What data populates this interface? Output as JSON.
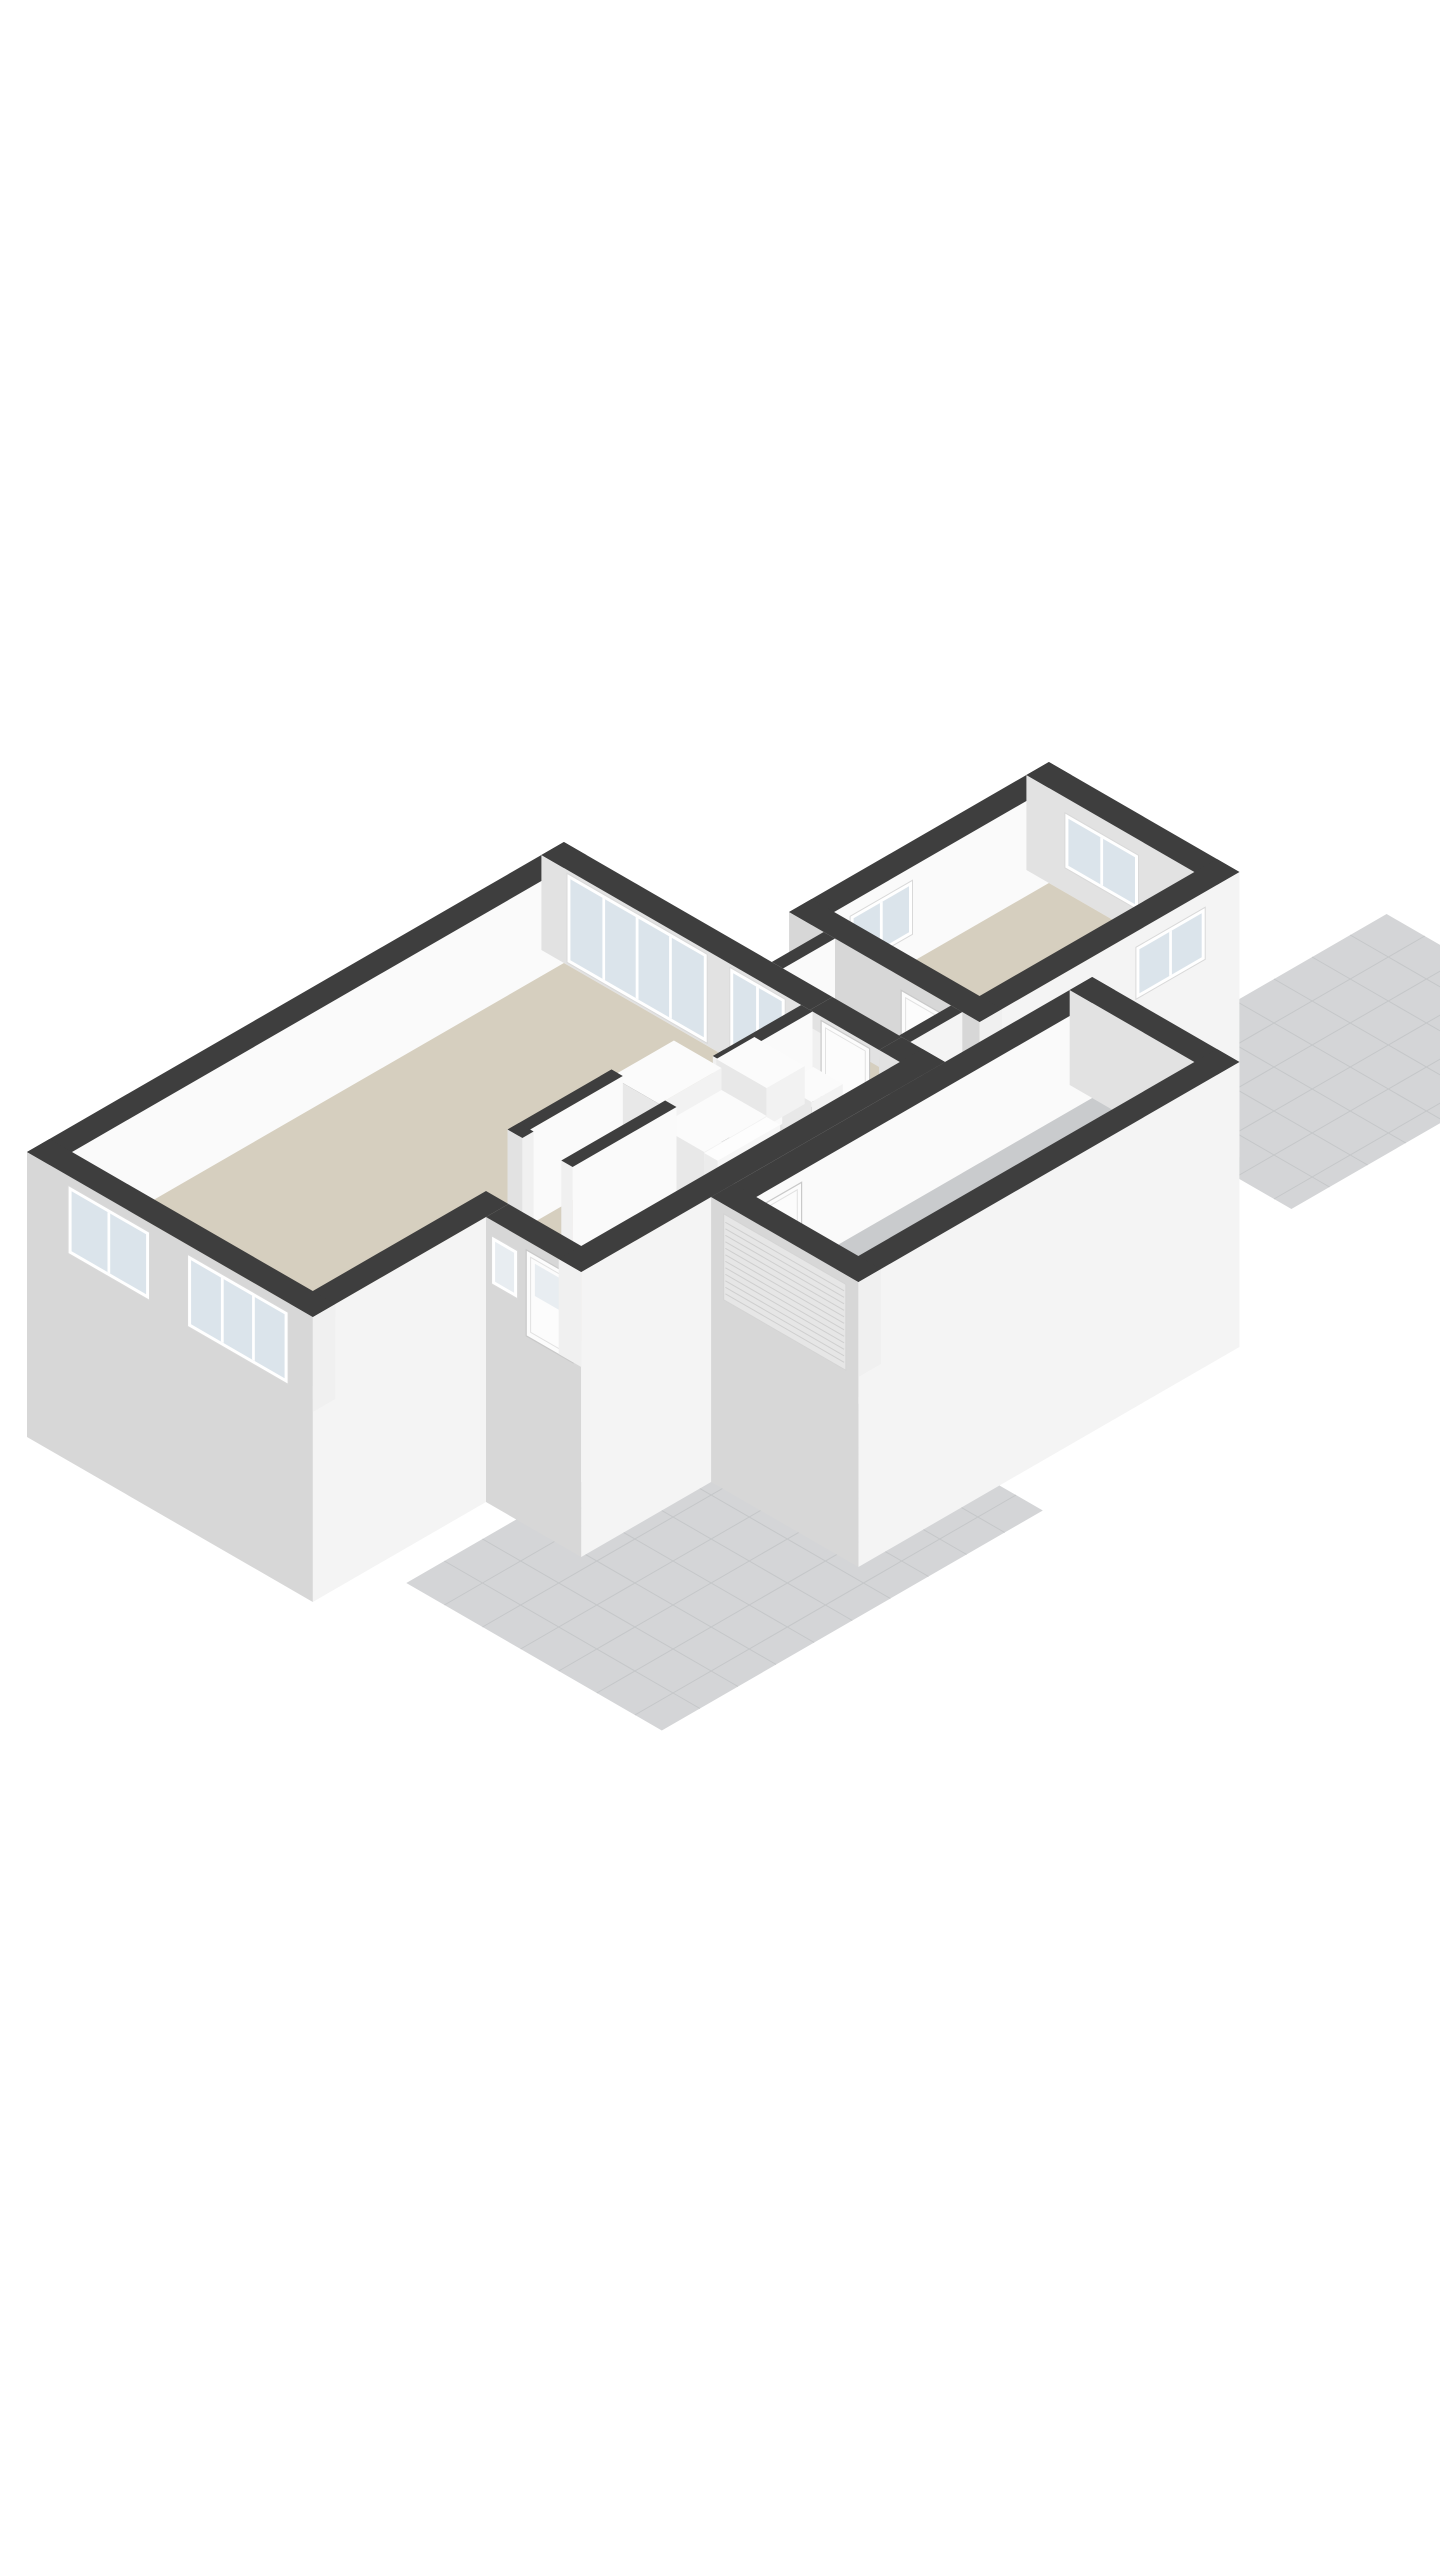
{
  "scene": {
    "background": "#ffffff",
    "projection": {
      "ox": 27,
      "oy": 1247,
      "ex": 0.866,
      "ey": 0.5,
      "wall_height": 95,
      "skirt": 190,
      "patio_drop": 22
    },
    "colors": {
      "wallTop": "#3e3e3e",
      "extX": "#d7d7d7",
      "extY": "#f4f4f4",
      "intX": "#e2e2e2",
      "intY": "#fafafa",
      "cap": "#f0f0f0",
      "floorBeige": "#d6cfbf",
      "floorGray": "#c9cbcd",
      "floorBlue": "#aabecb",
      "tile": "#d4d5d7",
      "tileLine": "#c5c7c9",
      "glass": "#dbe4eb",
      "glassFrosted": "#e8edf1",
      "frame": "#ffffff",
      "frameEdge": "#d9d9d9",
      "stepTop": "#fdfdfd",
      "stepSide": "#ececec",
      "riser": "#f6f6f6",
      "roller": "#e6e6e6",
      "rollerLine": "#cfcfcf",
      "doorFill": "#fcfcfc",
      "doorLine": "#c9c9c9",
      "boxTop": "#fbfbfb",
      "boxX": "#e8e8e8",
      "boxY": "#f2f2f2"
    },
    "elements": [
      {
        "type": "patio",
        "name": "terrace-southwest",
        "x0": -95,
        "y0": 533,
        "x1": 345,
        "y1": 828,
        "step": 44
      },
      {
        "type": "patio",
        "name": "terrace-northeast",
        "x0": 790,
        "y0": 430,
        "x1": 1140,
        "y1": 670,
        "step": 44
      },
      {
        "type": "wallE1",
        "name": "shed-wall-northwest",
        "x0": 680,
        "x1": 980,
        "y0": 200,
        "y1": 226
      },
      {
        "type": "winE1",
        "name": "shed-window-northwest",
        "y": 226.5,
        "x0": 724,
        "x1": 796,
        "z0": 28,
        "z1": 82,
        "panes": 2
      },
      {
        "type": "wallE2",
        "name": "shed-wall-northeast",
        "x0": 954,
        "x1": 980,
        "y0": 200,
        "y1": 420
      },
      {
        "type": "winE2",
        "name": "shed-window-northeast",
        "x": 953.5,
        "y0": 245,
        "y1": 330,
        "z0": 25,
        "z1": 80,
        "panes": 2
      },
      {
        "type": "floor",
        "name": "shed-floor",
        "fill": "floorBeige",
        "x0": 706,
        "y0": 226,
        "x1": 954,
        "y1": 394
      },
      {
        "type": "wallE1",
        "name": "shed-wall-southeast",
        "x0": 680,
        "x1": 980,
        "y0": 394,
        "y1": 420,
        "ext": true,
        "skirt": true
      },
      {
        "type": "winE1",
        "name": "shed-window-southeast",
        "y": 420.5,
        "x0": 860,
        "x1": 940,
        "z0": 28,
        "z1": 80,
        "panes": 2
      },
      {
        "type": "wallE2",
        "name": "shed-wall-southwest",
        "x0": 680,
        "x1": 706,
        "y0": 200,
        "y1": 420,
        "ext": true,
        "skirt": true
      },
      {
        "type": "doorE2",
        "name": "shed-door",
        "x": 679.5,
        "y0": 330,
        "y1": 384,
        "h": 82
      },
      {
        "type": "wallE1",
        "name": "link-wall-northwest",
        "x0": 620,
        "x1": 680,
        "y0": 240,
        "y1": 253
      },
      {
        "type": "floor",
        "name": "link-floor",
        "fill": "floorBeige",
        "x0": 620,
        "y0": 253,
        "x1": 680,
        "y1": 387
      },
      {
        "type": "wallE1",
        "name": "link-wall-southeast",
        "x0": 620,
        "x1": 680,
        "y0": 387,
        "y1": 400,
        "ext": true,
        "skirt": true
      },
      {
        "type": "wallE1",
        "name": "house-wall-northwest",
        "x0": 0,
        "x1": 620,
        "y0": 0,
        "y1": 26
      },
      {
        "type": "wallE2",
        "name": "house-wall-northeast-a",
        "x0": 594,
        "x1": 620,
        "y0": 0,
        "y1": 310
      },
      {
        "type": "wallE2",
        "name": "house-wall-northeast-b",
        "x0": 594,
        "x1": 620,
        "y0": 390,
        "y1": 440
      },
      {
        "type": "wallE2",
        "name": "house-wall-northeast-lintel",
        "x0": 594,
        "x1": 620,
        "y0": 310,
        "y1": 390,
        "z0": 78,
        "nocap": true
      },
      {
        "type": "winE2",
        "name": "living-sliding-door",
        "x": 593.5,
        "y0": 30,
        "y1": 192,
        "z0": 3,
        "z1": 92,
        "panes": 4
      },
      {
        "type": "winE2",
        "name": "living-window-tall",
        "x": 593.5,
        "y0": 218,
        "y1": 282,
        "z0": 10,
        "z1": 92,
        "panes": 2
      },
      {
        "type": "doorE2",
        "name": "passage-door",
        "x": 601,
        "y0": 316,
        "y1": 372,
        "h": 84
      },
      {
        "type": "floorPoly",
        "name": "living-hall-floor",
        "fill": "floorBeige",
        "pts": [
          [
            26,
            26
          ],
          [
            594,
            26
          ],
          [
            594,
            414
          ],
          [
            226,
            414
          ],
          [
            226,
            304
          ],
          [
            26,
            304
          ]
        ]
      },
      {
        "type": "floor",
        "name": "toilet-floor",
        "fill": "floorBlue",
        "x0": 505,
        "y0": 313,
        "x1": 594,
        "y1": 414
      },
      {
        "type": "wallE2",
        "name": "toilet-wall-west",
        "x0": 492,
        "x1": 505,
        "y0": 300,
        "y1": 414
      },
      {
        "type": "wallE1",
        "name": "toilet-wall-north",
        "x0": 492,
        "x1": 594,
        "y0": 300,
        "y1": 313
      },
      {
        "type": "box",
        "name": "toilet-cistern",
        "x0": 556,
        "y0": 316,
        "x1": 592,
        "y1": 350,
        "h": 42
      },
      {
        "type": "box",
        "name": "hall-cabinet",
        "x0": 548,
        "y0": 248,
        "x1": 592,
        "y1": 306,
        "h": 38
      },
      {
        "type": "wallE2",
        "name": "stair-wall-west",
        "x0": 407,
        "x1": 420,
        "y0": 255,
        "y1": 440
      },
      {
        "type": "box",
        "name": "stair-upper-flight",
        "x0": 420,
        "y0": 255,
        "x1": 492,
        "y1": 310,
        "h": 88
      },
      {
        "type": "box",
        "name": "stair-mid-flight",
        "x0": 420,
        "y0": 310,
        "x1": 492,
        "y1": 362,
        "h": 66
      },
      {
        "type": "steps",
        "name": "stair-steps",
        "x0": 420,
        "x1": 492,
        "yStart": 440,
        "n": 5,
        "depth": 15.6,
        "rise": 13
      },
      {
        "type": "wallE1",
        "name": "closet-wall-north",
        "x0": 300,
        "x1": 420,
        "y0": 255,
        "y1": 268
      },
      {
        "type": "wallE2",
        "name": "closet-wall-west",
        "x0": 300,
        "x1": 313,
        "y0": 255,
        "y1": 272
      },
      {
        "type": "wallE1",
        "name": "closet-wall-south",
        "x0": 300,
        "x1": 420,
        "y0": 317,
        "y1": 330
      },
      {
        "type": "wallE1",
        "name": "living-facade-southeast",
        "x0": 0,
        "x1": 226,
        "y0": 304,
        "y1": 330,
        "ext": true,
        "skirt": true
      },
      {
        "type": "wallE2",
        "name": "hall-gable-southwest",
        "x0": 200,
        "x1": 226,
        "y0": 330,
        "y1": 440,
        "ext": true,
        "skirt": true
      },
      {
        "type": "winE2",
        "name": "hall-window-frosted",
        "x": 199.5,
        "y0": 337,
        "y1": 367,
        "z0": 32,
        "z1": 80,
        "panes": 1,
        "frosted": true
      },
      {
        "type": "doorE2",
        "name": "front-door",
        "x": 199.5,
        "y0": 377,
        "y1": 431,
        "h": 86,
        "front": true
      },
      {
        "type": "wallE1",
        "name": "hall-facade-southeast",
        "x0": 200,
        "x1": 620,
        "y0": 414,
        "y1": 440,
        "ext": true,
        "skirt": true
      },
      {
        "type": "wallE2",
        "name": "house-facade-southwest",
        "x0": 0,
        "x1": 26,
        "y0": 0,
        "y1": 330,
        "ext": true,
        "skirt": true
      },
      {
        "type": "winE2",
        "name": "living-window-pair",
        "x": -0.5,
        "y0": 48,
        "y1": 142,
        "z0": 18,
        "z1": 86,
        "panes": 2
      },
      {
        "type": "winE2",
        "name": "living-window-triple",
        "x": -0.5,
        "y0": 186,
        "y1": 302,
        "z0": 14,
        "z1": 86,
        "panes": 3
      },
      {
        "type": "wallE1",
        "name": "garage-wall-northwest",
        "x0": 350,
        "x1": 790,
        "y0": 440,
        "y1": 466
      },
      {
        "type": "doorE1",
        "name": "garage-interior-door",
        "y": 466.5,
        "x0": 380,
        "x1": 428,
        "h": 84
      },
      {
        "type": "wallE2",
        "name": "garage-wall-northeast",
        "x0": 764,
        "x1": 790,
        "y0": 440,
        "y1": 610
      },
      {
        "type": "floor",
        "name": "garage-floor",
        "fill": "floorGray",
        "x0": 376,
        "y0": 466,
        "x1": 764,
        "y1": 584
      },
      {
        "type": "wallE1",
        "name": "garage-facade-southeast",
        "x0": 350,
        "x1": 790,
        "y0": 584,
        "y1": 610,
        "ext": true,
        "skirt": true
      },
      {
        "type": "wallE2",
        "name": "garage-gable-southwest",
        "x0": 350,
        "x1": 376,
        "y0": 440,
        "y1": 610,
        "ext": true,
        "skirt": true
      },
      {
        "type": "roller",
        "name": "garage-roller-door",
        "x": 349.5,
        "y0": 455,
        "y1": 596,
        "h": 86
      }
    ]
  }
}
